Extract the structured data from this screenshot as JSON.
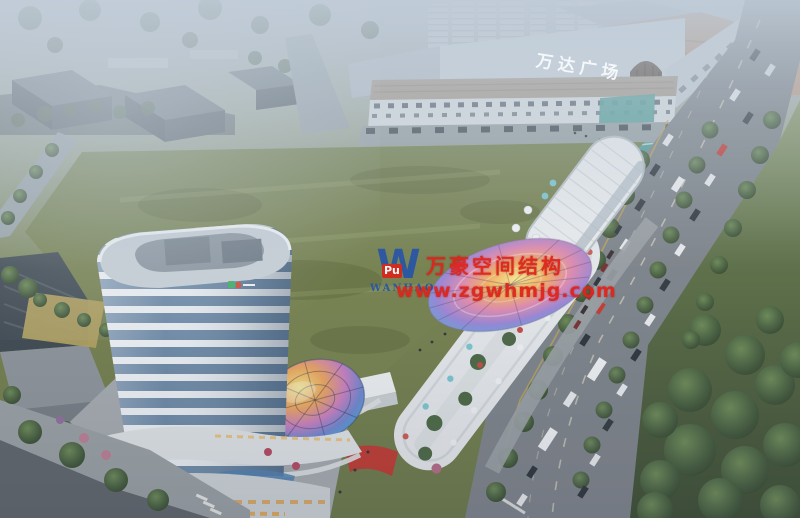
{
  "scene": {
    "mall_sign": "万达广场"
  },
  "watermark": {
    "logo_letter": "W",
    "logo_badge": "Pu",
    "brand": "WANHAO",
    "company": "万豪空间结构",
    "url": "www.zgwhmjg.com"
  },
  "colors": {
    "haze": "#bfccd8",
    "field_green": "#76814d",
    "park_green": "#4c6342",
    "road_gray": "#83888d",
    "tower_white": "#edf1f4",
    "tower_glass": "#6d89a6",
    "mall_wall": "#ccd4dc",
    "terracotta": "#b59077",
    "teal_glass": "#4f9d97",
    "canopy_rainbow": [
      "#f9ea8f",
      "#f4b063",
      "#e08bb0",
      "#9b86d6",
      "#62a7dd",
      "#74c4a2"
    ],
    "watermark_red": "#e0241c",
    "watermark_blue": "#2a56a5"
  }
}
